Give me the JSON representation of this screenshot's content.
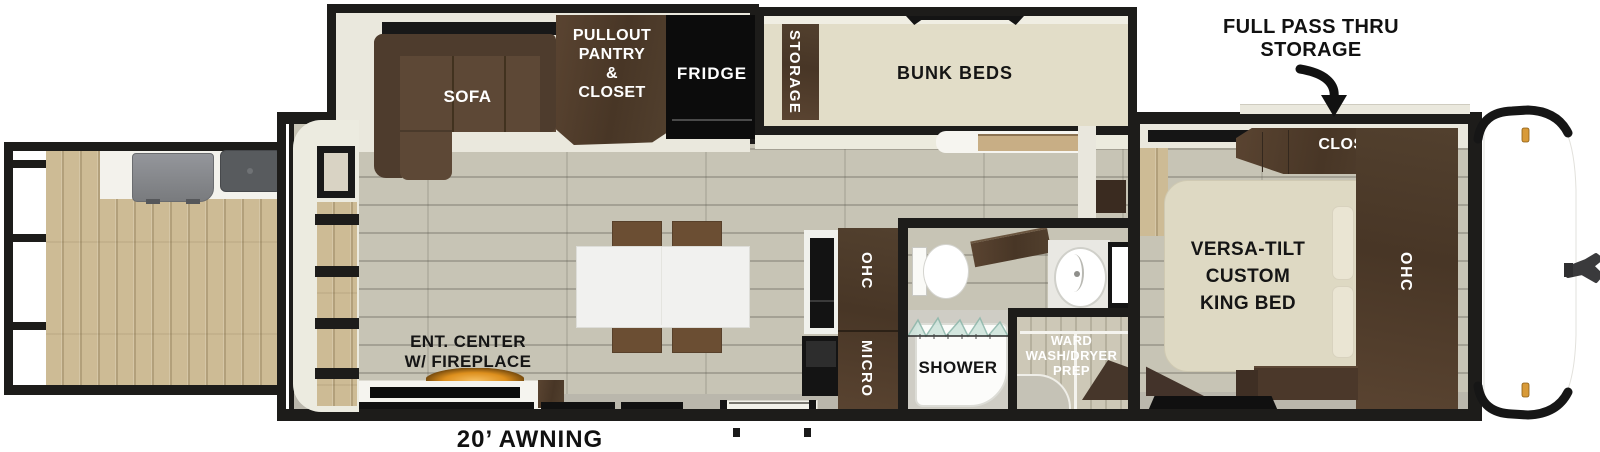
{
  "colors": {
    "wall": "#1d1c1a",
    "floor_main": "#c7c4b5",
    "deck_wood": "#cdbb95",
    "slide_cream": "#eae8dd",
    "bunk_beige": "#e2ddc8",
    "bed_beige": "#ded9c3",
    "cabinet_brown": "#4b382b",
    "sofa_brown": "#5d4836",
    "island_white": "#f1f1ef",
    "chair_brown": "#6b4e33",
    "appliance_black": "#0c0c0c",
    "amber_light": "#d89a38",
    "counter_grey": "#bab7ac"
  },
  "labels": {
    "sofa": "SOFA",
    "pantry_lines": [
      "PULLOUT",
      "PANTRY",
      "&",
      "CLOSET"
    ],
    "fridge": "FRIDGE",
    "storage": "STORAGE",
    "bunk_beds": "BUNK BEDS",
    "pass_thru_lines": [
      "FULL PASS THRU",
      "STORAGE"
    ],
    "closet": "CLOSET",
    "king_bed_lines": [
      "VERSA-TILT",
      "CUSTOM",
      "KING BED"
    ],
    "ohc_bedroom": "OHC",
    "ohc_kitchen": "OHC",
    "micro": "MICRO",
    "shower": "SHOWER",
    "ward_lines": [
      "WARD",
      "WASH/DRYER",
      "PREP"
    ],
    "ent_center_lines": [
      "ENT. CENTER",
      "W/ FIREPLACE"
    ],
    "awning": "20’ AWNING"
  }
}
